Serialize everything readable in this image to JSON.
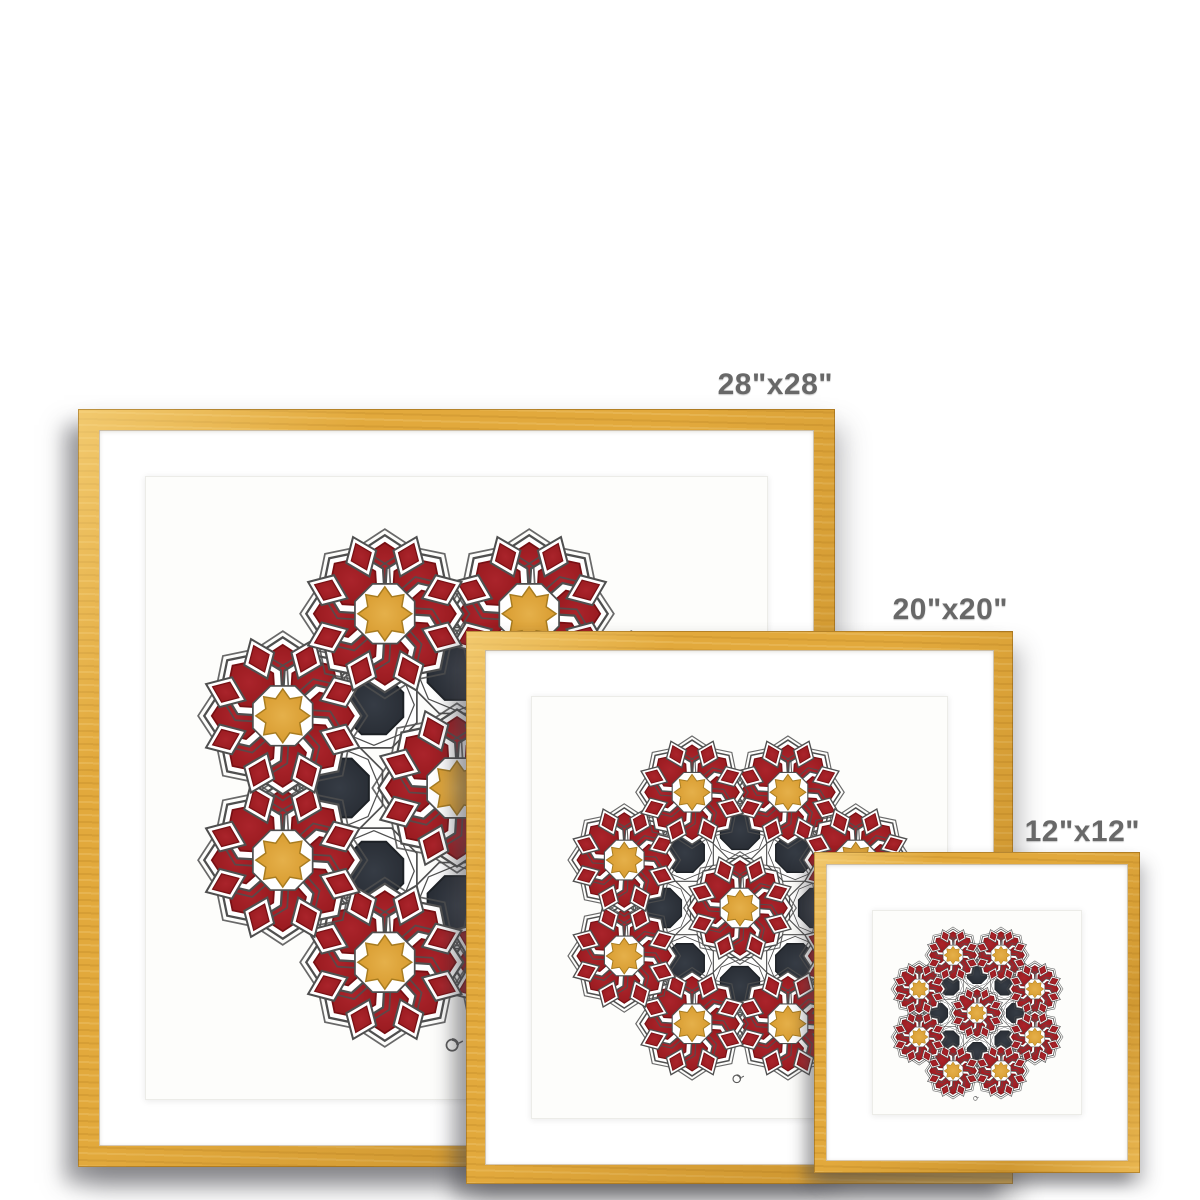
{
  "page": {
    "background": "#ffffff",
    "description": "framed art print size comparison mockup"
  },
  "labels": {
    "large": "28\"x28\"",
    "medium": "20\"x20\"",
    "small": "12\"x12\""
  },
  "frames": [
    {
      "name": "frame-28x28",
      "size_label": "28\"x28\"",
      "moulding": "natural gold wood",
      "mat": "white"
    },
    {
      "name": "frame-20x20",
      "size_label": "20\"x20\"",
      "moulding": "natural gold wood",
      "mat": "white"
    },
    {
      "name": "frame-12x12",
      "size_label": "12\"x12\"",
      "moulding": "natural gold wood",
      "mat": "white"
    }
  ],
  "artwork": {
    "style": "islamic-geometric-rosette-pattern",
    "rosettes": 9,
    "dark_octagons": 8,
    "petals_per_rosette": 8,
    "signature": "artist-monogram"
  },
  "colors": {
    "label_text": "#686868",
    "frame_wood": "#e2a93c",
    "frame_wood_light": "#f3c964",
    "frame_wood_dark": "#c78f22",
    "mat_white": "#ffffff",
    "paper_white": "#fdfdfb",
    "petal_red": "#9a1b20",
    "petal_red_deep": "#771014",
    "star_gold": "#d79a2e",
    "star_gold_deep": "#a87c20",
    "octagon_dark": "#2b3037",
    "outline_gray": "#4f4f4f",
    "shadow_gray": "#46464b"
  }
}
